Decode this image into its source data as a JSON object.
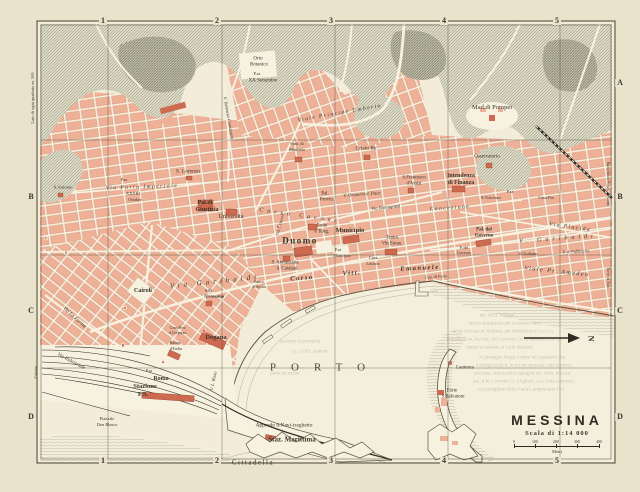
{
  "colors": {
    "paper": "#eae3cc",
    "map": "#f2ecd8",
    "street": "#f7f2e0",
    "block": "#eeb096",
    "blockdark": "#cd6a4f",
    "hill": "#dbd8c4",
    "hillline": "#8f8f7d",
    "coast": "#55523f",
    "ghost": "#a59e85",
    "red": "#b23a28",
    "ink": "#3a362b",
    "frame": "#4b4537",
    "water": "#f4efdc"
  },
  "title_block": {
    "title": "MESSINA",
    "scale_label": "Scala di 1:14 000",
    "unit": "Metri",
    "ticks": [
      "0",
      "100",
      "200",
      "300",
      "400"
    ]
  },
  "compass_letter": "N",
  "labels": [
    {
      "t": "1",
      "x": 103,
      "y": 21,
      "s": 8,
      "c": "grid",
      "n": "grid-col-1-top"
    },
    {
      "t": "2",
      "x": 217,
      "y": 21,
      "s": 8,
      "c": "grid",
      "n": "grid-col-2-top"
    },
    {
      "t": "3",
      "x": 331,
      "y": 21,
      "s": 8,
      "c": "grid",
      "n": "grid-col-3-top"
    },
    {
      "t": "4",
      "x": 444,
      "y": 21,
      "s": 8,
      "c": "grid",
      "n": "grid-col-4-top"
    },
    {
      "t": "5",
      "x": 557,
      "y": 21,
      "s": 8,
      "c": "grid",
      "n": "grid-col-5-top"
    },
    {
      "t": "1",
      "x": 103,
      "y": 461,
      "s": 8,
      "c": "grid",
      "n": "grid-col-1-bottom"
    },
    {
      "t": "2",
      "x": 217,
      "y": 461,
      "s": 8,
      "c": "grid",
      "n": "grid-col-2-bottom"
    },
    {
      "t": "3",
      "x": 331,
      "y": 461,
      "s": 8,
      "c": "grid",
      "n": "grid-col-3-bottom"
    },
    {
      "t": "4",
      "x": 444,
      "y": 461,
      "s": 8,
      "c": "grid",
      "n": "grid-col-4-bottom"
    },
    {
      "t": "5",
      "x": 557,
      "y": 461,
      "s": 8,
      "c": "grid",
      "n": "grid-col-5-bottom"
    },
    {
      "t": "A",
      "x": 620,
      "y": 83,
      "s": 8,
      "c": "grid",
      "n": "grid-row-a-right"
    },
    {
      "t": "B",
      "x": 620,
      "y": 197,
      "s": 8,
      "c": "grid",
      "n": "grid-row-b-right"
    },
    {
      "t": "C",
      "x": 620,
      "y": 311,
      "s": 8,
      "c": "grid",
      "n": "grid-row-c-right"
    },
    {
      "t": "D",
      "x": 620,
      "y": 417,
      "s": 8,
      "c": "grid",
      "n": "grid-row-d-right"
    },
    {
      "t": "B",
      "x": 31,
      "y": 197,
      "s": 8,
      "c": "grid",
      "n": "grid-row-b-left"
    },
    {
      "t": "C",
      "x": 31,
      "y": 311,
      "s": 8,
      "c": "grid",
      "n": "grid-row-c-left"
    },
    {
      "t": "D",
      "x": 31,
      "y": 417,
      "s": 8,
      "c": "grid",
      "n": "grid-row-d-left"
    },
    {
      "t": "Lato di ogni quadrato m. 500",
      "x": 33,
      "y": 98,
      "s": 4.4,
      "r": -90,
      "n": "grid-caption"
    },
    {
      "t": "Barcellona Pozzo di Gotto",
      "x": 608,
      "y": 184,
      "s": 4.2,
      "r": 90,
      "n": "edge-caption-barcellona"
    },
    {
      "t": "Torre di Faro",
      "x": 608,
      "y": 278,
      "s": 4.2,
      "r": 90,
      "n": "edge-caption-torre-di-faro"
    },
    {
      "t": "Catania",
      "x": 36,
      "y": 372,
      "s": 4.2,
      "r": -90,
      "n": "edge-caption-catania"
    },
    {
      "t": "Orto",
      "x": 258,
      "y": 59,
      "s": 5,
      "n": "label-orto-botanico"
    },
    {
      "t": "Botanico",
      "x": 259,
      "y": 65,
      "s": 5
    },
    {
      "t": "P.za",
      "x": 257,
      "y": 74,
      "s": 4.2
    },
    {
      "t": "XX Settembre",
      "x": 263,
      "y": 81,
      "s": 5
    },
    {
      "t": "Viale Principe Umberto",
      "x": 340,
      "y": 114,
      "s": 5.5,
      "r": -10,
      "c": "street sp1",
      "n": "street-viale-principe-umberto"
    },
    {
      "t": "V. Tommaso Cannizzaro",
      "x": 228,
      "y": 118,
      "s": 4.5,
      "r": 80,
      "c": "street",
      "n": "street-cannizzaro"
    },
    {
      "t": "Mad.di Pompei",
      "x": 492,
      "y": 108,
      "s": 6.5,
      "n": "label-madonna-di-pompei"
    },
    {
      "t": "Cristo Re",
      "x": 366,
      "y": 149,
      "s": 5.5,
      "n": "label-cristo-re"
    },
    {
      "t": "Sant. di",
      "x": 297,
      "y": 144,
      "s": 4.4
    },
    {
      "t": "Montalto",
      "x": 297,
      "y": 150,
      "s": 4.4
    },
    {
      "t": "Osservatorio",
      "x": 487,
      "y": 157,
      "s": 5,
      "n": "label-osservatorio"
    },
    {
      "t": "S. Lorenzo",
      "x": 188,
      "y": 172,
      "s": 5.5,
      "n": "label-san-lorenzo"
    },
    {
      "t": "S.Antonio",
      "x": 63,
      "y": 188,
      "s": 4.6,
      "n": "label-sant-antonio"
    },
    {
      "t": "Via Porta Imperiale",
      "x": 142,
      "y": 188,
      "s": 5.5,
      "r": -2,
      "c": "street sp1",
      "n": "street-porta-imperiale"
    },
    {
      "t": "P.za",
      "x": 124,
      "y": 180,
      "s": 4
    },
    {
      "t": "XXVIII",
      "x": 133,
      "y": 194,
      "s": 4.4
    },
    {
      "t": "Ottobre",
      "x": 135,
      "y": 200,
      "s": 4.4
    },
    {
      "t": "Pal.di",
      "x": 205,
      "y": 203,
      "s": 6,
      "c": "b",
      "n": "label-palazzo-giustizia"
    },
    {
      "t": "Giustizia",
      "x": 207,
      "y": 210,
      "s": 6,
      "c": "b"
    },
    {
      "t": "Università",
      "x": 231,
      "y": 217,
      "s": 6,
      "n": "label-universita"
    },
    {
      "t": "S.Francesco",
      "x": 414,
      "y": 179,
      "s": 4.8,
      "n": "label-san-francesco"
    },
    {
      "t": "d'Assisi",
      "x": 414,
      "y": 185,
      "s": 4.8
    },
    {
      "t": "Intendenza",
      "x": 461,
      "y": 177,
      "s": 5.8,
      "c": "b",
      "n": "label-intendenza-finanza"
    },
    {
      "t": "di Finanza",
      "x": 461,
      "y": 184,
      "s": 5.8,
      "c": "b"
    },
    {
      "t": "V. Oratorio d. Pace",
      "x": 362,
      "y": 196,
      "s": 4.8,
      "r": -4,
      "c": "street"
    },
    {
      "t": "Via Romagnosi",
      "x": 386,
      "y": 209,
      "s": 4.8,
      "r": -6,
      "c": "street"
    },
    {
      "t": "Corso Cavour",
      "x": 300,
      "y": 216,
      "s": 6,
      "r": 8,
      "c": "street sp2",
      "n": "street-corso-cavour"
    },
    {
      "t": "Pal.",
      "x": 325,
      "y": 195,
      "s": 4.8
    },
    {
      "t": "Provin.",
      "x": 327,
      "y": 201,
      "s": 4.8
    },
    {
      "t": "Poste",
      "x": 322,
      "y": 227,
      "s": 4.8,
      "n": "label-poste"
    },
    {
      "t": "e Teleg.",
      "x": 322,
      "y": 233,
      "s": 4.8
    },
    {
      "t": "Duomo",
      "x": 300,
      "y": 241,
      "s": 9,
      "c": "b sp1",
      "n": "label-duomo"
    },
    {
      "t": "P.za d. Duomo",
      "x": 281,
      "y": 225,
      "s": 3.8,
      "r": -75
    },
    {
      "t": "Municipio",
      "x": 350,
      "y": 231,
      "s": 6.5,
      "c": "b",
      "n": "label-municipio"
    },
    {
      "t": "P.za",
      "x": 338,
      "y": 250,
      "s": 4
    },
    {
      "t": "Municipio",
      "x": 342,
      "y": 256,
      "s": 4.2
    },
    {
      "t": "Casa",
      "x": 373,
      "y": 258,
      "s": 4.4
    },
    {
      "t": "Littoria",
      "x": 373,
      "y": 264,
      "s": 4.4
    },
    {
      "t": "Teatro",
      "x": 392,
      "y": 239,
      "s": 4.8,
      "n": "label-teatro"
    },
    {
      "t": "Vitt.Eman.",
      "x": 392,
      "y": 245,
      "s": 4.8
    },
    {
      "t": "S. Annunziata",
      "x": 285,
      "y": 264,
      "s": 4.8,
      "n": "label-annunziata"
    },
    {
      "t": "d. Catalani",
      "x": 287,
      "y": 270,
      "s": 4.8
    },
    {
      "t": "Banco",
      "x": 259,
      "y": 283,
      "s": 3.8
    },
    {
      "t": "di Sicilia",
      "x": 259,
      "y": 288,
      "s": 3.8
    },
    {
      "t": "Via Garibaldi",
      "x": 215,
      "y": 282,
      "s": 7,
      "r": -6,
      "c": "street sp2",
      "n": "street-via-garibaldi"
    },
    {
      "t": "S.M.",
      "x": 209,
      "y": 291,
      "s": 4.2
    },
    {
      "t": "Alemanna",
      "x": 214,
      "y": 297,
      "s": 4.6,
      "c": "b"
    },
    {
      "t": "Concezione",
      "x": 450,
      "y": 209,
      "s": 5.5,
      "r": -4,
      "c": "street sp1"
    },
    {
      "t": "P.za",
      "x": 510,
      "y": 192,
      "s": 4
    },
    {
      "t": "S.Vincenzo",
      "x": 491,
      "y": 198,
      "s": 4.4
    },
    {
      "t": "Casa Pia",
      "x": 546,
      "y": 198,
      "s": 4.4,
      "n": "label-casa-pia"
    },
    {
      "t": "Via Placida",
      "x": 570,
      "y": 228,
      "s": 5.5,
      "r": 8,
      "c": "street sp1"
    },
    {
      "t": "V. Garibaldi",
      "x": 558,
      "y": 239,
      "s": 6,
      "r": -4,
      "c": "street sp2"
    },
    {
      "t": "S.Giuliano",
      "x": 528,
      "y": 254,
      "s": 4.4
    },
    {
      "t": "V. d. Fabbriche",
      "x": 576,
      "y": 252,
      "s": 4.4,
      "r": -3,
      "c": "street"
    },
    {
      "t": "Pal. del",
      "x": 484,
      "y": 230,
      "s": 5,
      "c": "b",
      "n": "label-palazzo-governo"
    },
    {
      "t": "Governo",
      "x": 484,
      "y": 236,
      "s": 5,
      "c": "b"
    },
    {
      "t": "P. del",
      "x": 464,
      "y": 248,
      "s": 4
    },
    {
      "t": "Governo",
      "x": 464,
      "y": 253,
      "s": 4
    },
    {
      "t": "Viale Pr. Amedeo",
      "x": 557,
      "y": 272,
      "s": 6,
      "r": 6,
      "c": "street sp1",
      "n": "street-viale-amedeo"
    },
    {
      "t": "Corso",
      "x": 302,
      "y": 279,
      "s": 6.5,
      "r": -4,
      "c": "street sp1 b",
      "n": "street-corso-vitt-emanuele"
    },
    {
      "t": "Vitt.",
      "x": 352,
      "y": 274,
      "s": 6.5,
      "r": -3,
      "c": "street sp1 b"
    },
    {
      "t": "Emanuele",
      "x": 420,
      "y": 269,
      "s": 6.5,
      "r": -3,
      "c": "street sp1 b"
    },
    {
      "t": "Cap. di Porto",
      "x": 436,
      "y": 277,
      "s": 4.2,
      "r": -3,
      "n": "label-capitaneria"
    },
    {
      "t": "Cairoli",
      "x": 143,
      "y": 291,
      "s": 6,
      "c": "b",
      "n": "label-piazza-cairoli"
    },
    {
      "t": "Via La Farina",
      "x": 74,
      "y": 318,
      "s": 5.2,
      "r": 42,
      "c": "street",
      "n": "street-la-farina"
    },
    {
      "t": "Via Industriale",
      "x": 71,
      "y": 362,
      "s": 5.2,
      "r": 28,
      "c": "street"
    },
    {
      "t": "V. L. Rizzo",
      "x": 214,
      "y": 381,
      "s": 4.6,
      "r": -78,
      "c": "street"
    },
    {
      "t": "Cons.Prov.",
      "x": 178,
      "y": 329,
      "s": 3.8
    },
    {
      "t": "d.Corporaz.",
      "x": 178,
      "y": 334,
      "s": 3.8
    },
    {
      "t": "Banca",
      "x": 175,
      "y": 343,
      "s": 4.4,
      "n": "label-banca-italia"
    },
    {
      "t": "d'Italia",
      "x": 176,
      "y": 349,
      "s": 4.4
    },
    {
      "t": "Dogana",
      "x": 216,
      "y": 338,
      "s": 6.5,
      "c": "b",
      "n": "label-dogana"
    },
    {
      "t": "P.za",
      "x": 149,
      "y": 371,
      "s": 4
    },
    {
      "t": "Roma",
      "x": 161,
      "y": 379,
      "s": 6,
      "c": "b",
      "n": "label-piazza-roma"
    },
    {
      "t": "Stazione",
      "x": 145,
      "y": 387,
      "s": 6.5,
      "c": "b",
      "n": "label-stazione"
    },
    {
      "t": "F.S.",
      "x": 143,
      "y": 395,
      "s": 6.5,
      "c": "b"
    },
    {
      "t": "Piazzale",
      "x": 107,
      "y": 419,
      "s": 4.4
    },
    {
      "t": "Don Blasco",
      "x": 107,
      "y": 425,
      "s": 4.4
    },
    {
      "t": "Approdo d.Navi-traghetto",
      "x": 284,
      "y": 426,
      "s": 5.5,
      "n": "label-approdo"
    },
    {
      "t": "Staz. Marittima",
      "x": 292,
      "y": 440,
      "s": 7,
      "c": "b",
      "n": "label-stazione-marittima"
    },
    {
      "t": "Cittadella",
      "x": 253,
      "y": 463,
      "s": 7,
      "c": "sp1",
      "n": "label-cittadella"
    },
    {
      "t": "PORTO",
      "x": 325,
      "y": 368,
      "s": 11,
      "c": "porto",
      "n": "label-porto"
    },
    {
      "t": "Lanterna",
      "x": 465,
      "y": 368,
      "s": 5,
      "n": "label-lanterna"
    },
    {
      "t": "Forte",
      "x": 452,
      "y": 391,
      "s": 5,
      "n": "label-forte-salvatore"
    },
    {
      "t": "S.Salvatore",
      "x": 453,
      "y": 397,
      "s": 5
    },
    {
      "t": "c",
      "x": 46,
      "y": 238,
      "s": 4.4,
      "c": "red"
    },
    {
      "t": "f",
      "x": 66,
      "y": 253,
      "s": 4.4,
      "c": "red"
    },
    {
      "t": "e",
      "x": 125,
      "y": 308,
      "s": 4.4,
      "c": "red"
    },
    {
      "t": "g",
      "x": 123,
      "y": 345,
      "s": 4.4,
      "c": "red"
    },
    {
      "t": "a",
      "x": 163,
      "y": 362,
      "s": 4.4,
      "c": "red"
    },
    {
      "t": "b",
      "x": 204,
      "y": 331,
      "s": 4.4,
      "c": "red"
    },
    {
      "t": "h",
      "x": 278,
      "y": 227,
      "s": 4.4,
      "c": "red"
    },
    {
      "t": "secondo la primitiva",
      "x": 300,
      "y": 342,
      "s": 5,
      "c": "ghost"
    },
    {
      "t": "(c. 1190), quando",
      "x": 310,
      "y": 352,
      "s": 5,
      "c": "ghost"
    },
    {
      "t": "parte ad alcuni",
      "x": 285,
      "y": 374,
      "s": 5,
      "c": "ghost"
    },
    {
      "t": "nel 1853, rimasta",
      "x": 497,
      "y": 316,
      "s": 5,
      "c": "ghost"
    },
    {
      "t": "arriva alla piazza del Governo (4B),",
      "x": 505,
      "y": 324,
      "s": 5,
      "c": "ghost"
    },
    {
      "t": "della colonna di Nettuno, del Montorsoli (1557), e",
      "x": 503,
      "y": 332,
      "s": 5,
      "c": "ghost"
    },
    {
      "t": "limitata a sin. dal Pal. del Governo, di G. Bazzani, sul cui",
      "x": 504,
      "y": 340,
      "s": 5,
      "c": "ghost"
    },
    {
      "t": "fianco si estende la Villa Mazzini.",
      "x": 500,
      "y": 348,
      "s": 5,
      "c": "ghost"
    },
    {
      "t": "Si prosegue lungo il mare nel quartiere che",
      "x": 522,
      "y": 358,
      "s": 5,
      "c": "ghost"
    },
    {
      "t": "s'allarga sulla d. in un bel piazzale, alla Batteria",
      "x": 524,
      "y": 366,
      "s": 5,
      "c": "ghost"
    },
    {
      "t": "siciliana, eroica nella battaglia del 1866, lascia a",
      "x": 522,
      "y": 374,
      "s": 5,
      "c": "ghost"
    },
    {
      "t": "sin. il R. Convitto D. Alighieri, e la Villa Umberto,",
      "x": 524,
      "y": 382,
      "s": 5,
      "c": "ghost"
    },
    {
      "t": "coi padiglioni della Fiera Campionaria Sici-",
      "x": 522,
      "y": 390,
      "s": 5,
      "c": "ghost"
    }
  ]
}
